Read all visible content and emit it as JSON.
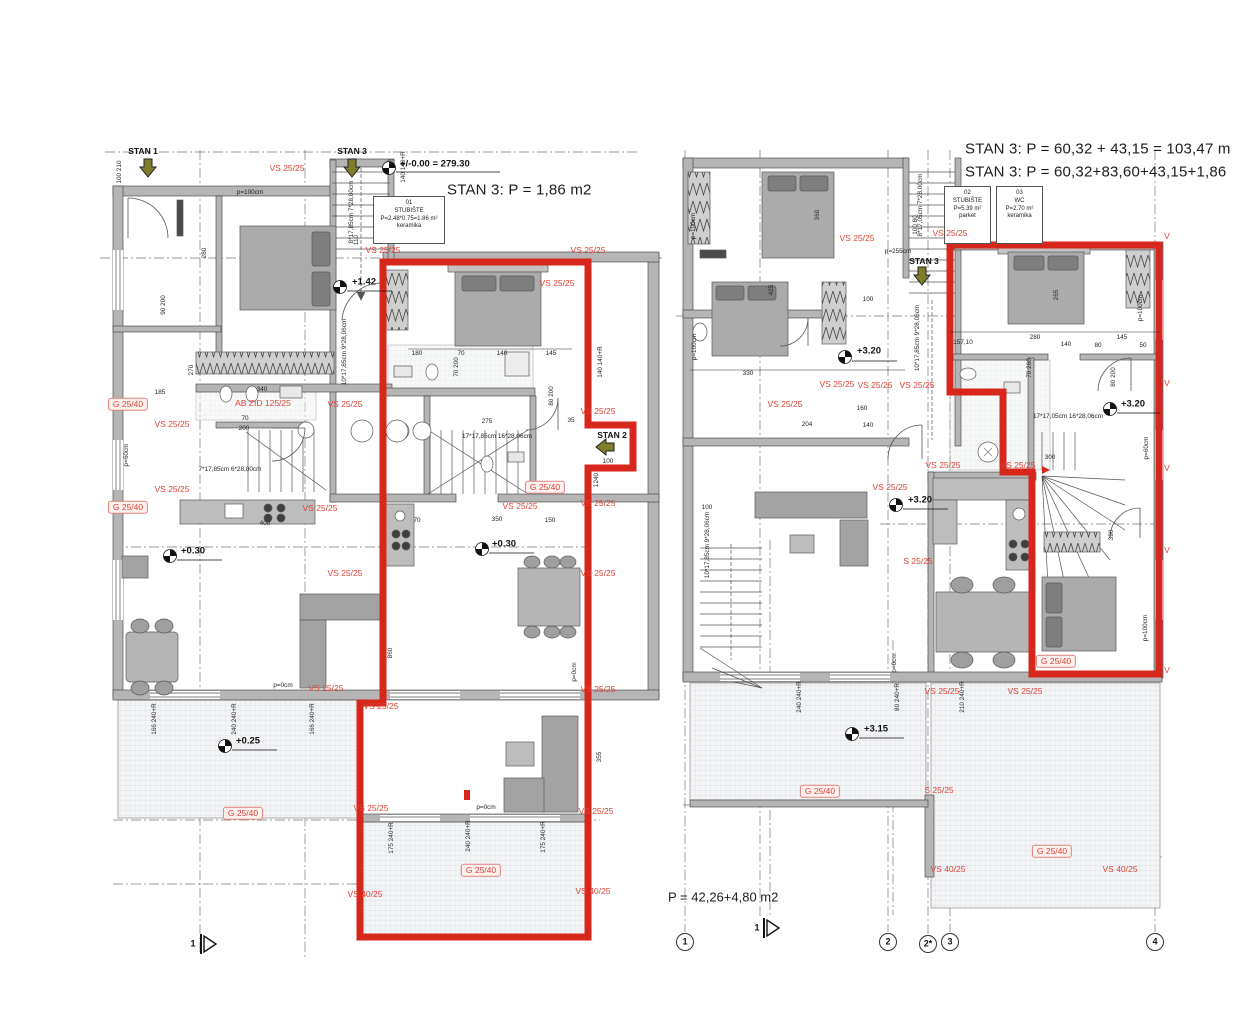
{
  "colors": {
    "outline_red": "#d7261b",
    "label_red": "#e04237",
    "wall_gray": "#b5b5b5"
  },
  "room_boxes": [
    {
      "id": "01",
      "name": "STUBIŠTE",
      "calc": "P=2.48*0.75=1.86 m²",
      "floor": "keramika"
    },
    {
      "id": "02",
      "name": "STUBIŠTE",
      "calc": "P=5.39 m²",
      "floor": "parket"
    },
    {
      "id": "03",
      "name": "WC",
      "calc": "P=2.70 m²",
      "floor": "keramika"
    }
  ],
  "labels": [
    {
      "t": "STAN 3: P = 1,86 m2",
      "x": 447,
      "y": 190,
      "c": "title",
      "a": "l",
      "n": "left-plan-title"
    },
    {
      "t": "STAN 3: P = 60,32 + 43,15 = 103,47 m",
      "x": 965,
      "y": 149,
      "c": "title",
      "a": "l",
      "n": "right-plan-title-1"
    },
    {
      "t": "STAN 3: P = 60,32+83,60+43,15+1,86",
      "x": 965,
      "y": 172,
      "c": "title",
      "a": "l",
      "n": "right-plan-title-2"
    },
    {
      "t": "P = 42,26+4,80 m2",
      "x": 668,
      "y": 897,
      "c": "title2",
      "a": "l",
      "n": "terrace-area-text"
    },
    {
      "t": "STAN 1",
      "x": 143,
      "y": 151,
      "c": "black",
      "n": "entrance-stan1"
    },
    {
      "t": "STAN 3",
      "x": 352,
      "y": 151,
      "c": "black",
      "n": "entrance-stan3-left"
    },
    {
      "t": "STAN 2",
      "x": 612,
      "y": 435,
      "c": "black",
      "n": "entrance-stan2"
    },
    {
      "t": "STAN 3",
      "x": 924,
      "y": 261,
      "c": "black",
      "n": "entrance-stan3-right"
    },
    {
      "t": "+/-0.00 = 279.30",
      "x": 400,
      "y": 164,
      "c": "elev",
      "a": "l"
    },
    {
      "t": "+1.42",
      "x": 352,
      "y": 282,
      "c": "elev",
      "a": "l"
    },
    {
      "t": "+0.30",
      "x": 181,
      "y": 551,
      "c": "elev",
      "a": "l"
    },
    {
      "t": "+0.30",
      "x": 492,
      "y": 544,
      "c": "elev",
      "a": "l"
    },
    {
      "t": "+0.25",
      "x": 236,
      "y": 741,
      "c": "elev",
      "a": "l"
    },
    {
      "t": "+3.20",
      "x": 857,
      "y": 351,
      "c": "elev",
      "a": "l"
    },
    {
      "t": "+3.20",
      "x": 1121,
      "y": 404,
      "c": "elev",
      "a": "l"
    },
    {
      "t": "+3.20",
      "x": 908,
      "y": 500,
      "c": "elev",
      "a": "l"
    },
    {
      "t": "+3.15",
      "x": 864,
      "y": 729,
      "c": "elev",
      "a": "l"
    },
    {
      "t": "VS 25/25",
      "x": 287,
      "y": 168,
      "c": "red"
    },
    {
      "t": "VS 25/25",
      "x": 383,
      "y": 250,
      "c": "red"
    },
    {
      "t": "VS 25/25",
      "x": 588,
      "y": 250,
      "c": "red"
    },
    {
      "t": "VS 25/25",
      "x": 557,
      "y": 283,
      "c": "red"
    },
    {
      "t": "G 25/40",
      "x": 128,
      "y": 404,
      "c": "redbox"
    },
    {
      "t": "AB ZID 125/25",
      "x": 263,
      "y": 403,
      "c": "red"
    },
    {
      "t": "VS 25/25",
      "x": 345,
      "y": 404,
      "c": "red"
    },
    {
      "t": "VS 25/25",
      "x": 172,
      "y": 424,
      "c": "red"
    },
    {
      "t": "VS 25/25",
      "x": 598,
      "y": 411,
      "c": "red"
    },
    {
      "t": "VS 25/25",
      "x": 172,
      "y": 489,
      "c": "red"
    },
    {
      "t": "G 25/40",
      "x": 128,
      "y": 507,
      "c": "redbox"
    },
    {
      "t": "VS 25/25",
      "x": 320,
      "y": 508,
      "c": "red"
    },
    {
      "t": "VS 25/25",
      "x": 520,
      "y": 506,
      "c": "red"
    },
    {
      "t": "G 25/40",
      "x": 545,
      "y": 487,
      "c": "redbox"
    },
    {
      "t": "VS 25/25",
      "x": 598,
      "y": 503,
      "c": "red"
    },
    {
      "t": "VS 25/25",
      "x": 345,
      "y": 573,
      "c": "red"
    },
    {
      "t": "VS 25/25",
      "x": 598,
      "y": 573,
      "c": "red"
    },
    {
      "t": "VS 25/25",
      "x": 326,
      "y": 688,
      "c": "red"
    },
    {
      "t": "VS 25/25",
      "x": 381,
      "y": 706,
      "c": "red"
    },
    {
      "t": "VS 25/25",
      "x": 598,
      "y": 689,
      "c": "red"
    },
    {
      "t": "G 25/40",
      "x": 243,
      "y": 813,
      "c": "redbox"
    },
    {
      "t": "VS 25/25",
      "x": 371,
      "y": 808,
      "c": "red"
    },
    {
      "t": "VS 25/25",
      "x": 596,
      "y": 811,
      "c": "red"
    },
    {
      "t": "G 25/40",
      "x": 481,
      "y": 870,
      "c": "redbox"
    },
    {
      "t": "VS 40/25",
      "x": 365,
      "y": 894,
      "c": "red"
    },
    {
      "t": "VS 40/25",
      "x": 593,
      "y": 891,
      "c": "red"
    },
    {
      "t": "VS 25/25",
      "x": 857,
      "y": 238,
      "c": "red"
    },
    {
      "t": "VS 25/25",
      "x": 950,
      "y": 233,
      "c": "red"
    },
    {
      "t": "VS 25/25",
      "x": 785,
      "y": 404,
      "c": "red"
    },
    {
      "t": "VS 25/25",
      "x": 837,
      "y": 384,
      "c": "red"
    },
    {
      "t": "VS 25/25",
      "x": 875,
      "y": 385,
      "c": "red"
    },
    {
      "t": "VS 25/25",
      "x": 917,
      "y": 385,
      "c": "red"
    },
    {
      "t": "VS 25/25",
      "x": 890,
      "y": 487,
      "c": "red"
    },
    {
      "t": "VS 25/25",
      "x": 943,
      "y": 465,
      "c": "red"
    },
    {
      "t": "VS 25/25",
      "x": 1018,
      "y": 465,
      "c": "red"
    },
    {
      "t": "S 25/25",
      "x": 918,
      "y": 561,
      "c": "red"
    },
    {
      "t": "VS 25/25",
      "x": 942,
      "y": 691,
      "c": "red"
    },
    {
      "t": "VS 25/25",
      "x": 1025,
      "y": 691,
      "c": "red"
    },
    {
      "t": "S 25/25",
      "x": 939,
      "y": 790,
      "c": "red"
    },
    {
      "t": "G 25/40",
      "x": 1056,
      "y": 661,
      "c": "redbox"
    },
    {
      "t": "G 25/40",
      "x": 820,
      "y": 791,
      "c": "redbox"
    },
    {
      "t": "VS 40/25",
      "x": 948,
      "y": 869,
      "c": "red"
    },
    {
      "t": "VS 40/25",
      "x": 1120,
      "y": 869,
      "c": "red"
    },
    {
      "t": "G 25/40",
      "x": 1052,
      "y": 851,
      "c": "redbox"
    },
    {
      "t": "V",
      "x": 1167,
      "y": 236,
      "c": "red"
    },
    {
      "t": "V",
      "x": 1167,
      "y": 383,
      "c": "red"
    },
    {
      "t": "V",
      "x": 1167,
      "y": 468,
      "c": "red"
    },
    {
      "t": "V",
      "x": 1167,
      "y": 550,
      "c": "red"
    },
    {
      "t": "V",
      "x": 1167,
      "y": 670,
      "c": "red"
    },
    {
      "t": "100 210",
      "x": 120,
      "y": 172,
      "c": "dim",
      "r": -90
    },
    {
      "t": "140 140+R",
      "x": 404,
      "y": 167,
      "c": "dim",
      "r": -90
    },
    {
      "t": "p=100cm",
      "x": 250,
      "y": 193,
      "c": "dim"
    },
    {
      "t": "280",
      "x": 205,
      "y": 253,
      "c": "dim",
      "r": -90
    },
    {
      "t": "90 200",
      "x": 164,
      "y": 305,
      "c": "dim",
      "r": -90
    },
    {
      "t": "270",
      "x": 192,
      "y": 370,
      "c": "dim",
      "r": -90
    },
    {
      "t": "185",
      "x": 160,
      "y": 393,
      "c": "dim"
    },
    {
      "t": "340",
      "x": 262,
      "y": 390,
      "c": "dim"
    },
    {
      "t": "70",
      "x": 245,
      "y": 419,
      "c": "dim"
    },
    {
      "t": "200",
      "x": 244,
      "y": 429,
      "c": "dim"
    },
    {
      "t": "p=60cm",
      "x": 127,
      "y": 455,
      "c": "dim",
      "r": -90
    },
    {
      "t": "110",
      "x": 357,
      "y": 240,
      "c": "dim",
      "r": -90
    },
    {
      "t": "8*17,85cm 7*28,00cm",
      "x": 352,
      "y": 212,
      "c": "dim",
      "r": -90
    },
    {
      "t": "10*17,85cm 9*28,06cm",
      "x": 345,
      "y": 352,
      "c": "dim",
      "r": -90
    },
    {
      "t": "7*17,85cm 6*28,00cm",
      "x": 230,
      "y": 470,
      "c": "dim"
    },
    {
      "t": "17*17,85cm 16*28,06cm",
      "x": 497,
      "y": 437,
      "c": "dim"
    },
    {
      "t": "180",
      "x": 417,
      "y": 354,
      "c": "dim"
    },
    {
      "t": "70",
      "x": 461,
      "y": 354,
      "c": "dim"
    },
    {
      "t": "140",
      "x": 502,
      "y": 354,
      "c": "dim"
    },
    {
      "t": "145",
      "x": 551,
      "y": 354,
      "c": "dim"
    },
    {
      "t": "70 200",
      "x": 457,
      "y": 367,
      "c": "dim",
      "r": -90
    },
    {
      "t": "275",
      "x": 487,
      "y": 422,
      "c": "dim"
    },
    {
      "t": "80 200",
      "x": 552,
      "y": 396,
      "c": "dim",
      "r": -90
    },
    {
      "t": "35",
      "x": 571,
      "y": 421,
      "c": "dim"
    },
    {
      "t": "1240",
      "x": 597,
      "y": 480,
      "c": "dim",
      "r": -90
    },
    {
      "t": "140 140+R",
      "x": 601,
      "y": 362,
      "c": "dim",
      "r": -90
    },
    {
      "t": "100",
      "x": 608,
      "y": 462,
      "c": "dim"
    },
    {
      "t": "400",
      "x": 265,
      "y": 524,
      "c": "dim"
    },
    {
      "t": "70",
      "x": 417,
      "y": 521,
      "c": "dim"
    },
    {
      "t": "350",
      "x": 497,
      "y": 520,
      "c": "dim"
    },
    {
      "t": "150",
      "x": 550,
      "y": 521,
      "c": "dim"
    },
    {
      "t": "860",
      "x": 391,
      "y": 653,
      "c": "dim",
      "r": -90
    },
    {
      "t": "355",
      "x": 600,
      "y": 757,
      "c": "dim",
      "r": -90
    },
    {
      "t": "p=0cm",
      "x": 283,
      "y": 686,
      "c": "dim"
    },
    {
      "t": "166 240+R",
      "x": 155,
      "y": 719,
      "c": "dim",
      "r": -90
    },
    {
      "t": "240 240+R",
      "x": 235,
      "y": 719,
      "c": "dim",
      "r": -90
    },
    {
      "t": "166 240+R",
      "x": 313,
      "y": 719,
      "c": "dim",
      "r": -90
    },
    {
      "t": "p=0cm",
      "x": 486,
      "y": 808,
      "c": "dim"
    },
    {
      "t": "p=0cm",
      "x": 575,
      "y": 672,
      "c": "dim",
      "r": -90
    },
    {
      "t": "175 240+R",
      "x": 392,
      "y": 838,
      "c": "dim",
      "r": -90
    },
    {
      "t": "240 240+R",
      "x": 469,
      "y": 836,
      "c": "dim",
      "r": -90
    },
    {
      "t": "175 240+R",
      "x": 544,
      "y": 837,
      "c": "dim",
      "r": -90
    },
    {
      "t": "p=100cm",
      "x": 694,
      "y": 226,
      "c": "dim",
      "r": -90
    },
    {
      "t": "p=100cm",
      "x": 695,
      "y": 347,
      "c": "dim",
      "r": -90
    },
    {
      "t": "360",
      "x": 818,
      "y": 215,
      "c": "dim",
      "r": -90
    },
    {
      "t": "425",
      "x": 772,
      "y": 290,
      "c": "dim",
      "r": -90
    },
    {
      "t": "330",
      "x": 748,
      "y": 374,
      "c": "dim"
    },
    {
      "t": "100",
      "x": 868,
      "y": 300,
      "c": "dim"
    },
    {
      "t": "100 80",
      "x": 916,
      "y": 225,
      "c": "dim",
      "r": -90
    },
    {
      "t": "8*17,05cm 7*28,00cm",
      "x": 921,
      "y": 205,
      "c": "dim",
      "r": -90
    },
    {
      "t": "p=255cm",
      "x": 898,
      "y": 252,
      "c": "dim"
    },
    {
      "t": "10*17,85cm 9*28,06cm",
      "x": 918,
      "y": 338,
      "c": "dim",
      "r": -90
    },
    {
      "t": "10*17,85cm 9*28,06cm",
      "x": 708,
      "y": 545,
      "c": "dim",
      "r": -90
    },
    {
      "t": "100",
      "x": 707,
      "y": 508,
      "c": "dim"
    },
    {
      "t": "157,10",
      "x": 963,
      "y": 343,
      "c": "dim"
    },
    {
      "t": "280",
      "x": 1035,
      "y": 338,
      "c": "dim"
    },
    {
      "t": "140",
      "x": 1066,
      "y": 345,
      "c": "dim"
    },
    {
      "t": "145",
      "x": 1122,
      "y": 338,
      "c": "dim"
    },
    {
      "t": "80",
      "x": 1098,
      "y": 346,
      "c": "dim"
    },
    {
      "t": "50",
      "x": 1143,
      "y": 346,
      "c": "dim"
    },
    {
      "t": "265",
      "x": 1057,
      "y": 295,
      "c": "dim",
      "r": -90
    },
    {
      "t": "70 260",
      "x": 1030,
      "y": 368,
      "c": "dim",
      "r": -90
    },
    {
      "t": "80 200",
      "x": 1114,
      "y": 377,
      "c": "dim",
      "r": -90
    },
    {
      "t": "p=100cm",
      "x": 1141,
      "y": 308,
      "c": "dim",
      "r": -90
    },
    {
      "t": "p=60cm",
      "x": 1147,
      "y": 448,
      "c": "dim",
      "r": -90
    },
    {
      "t": "17*17,05cm 16*28,06cm",
      "x": 1068,
      "y": 417,
      "c": "dim"
    },
    {
      "t": "390",
      "x": 1112,
      "y": 535,
      "c": "dim",
      "r": -90
    },
    {
      "t": "300",
      "x": 1050,
      "y": 458,
      "c": "dim"
    },
    {
      "t": "p=100cm",
      "x": 1146,
      "y": 628,
      "c": "dim",
      "r": -90
    },
    {
      "t": "240 240+R",
      "x": 800,
      "y": 697,
      "c": "dim",
      "r": -90
    },
    {
      "t": "80 240+R",
      "x": 898,
      "y": 697,
      "c": "dim",
      "r": -90
    },
    {
      "t": "210 240+R",
      "x": 963,
      "y": 697,
      "c": "dim",
      "r": -90
    },
    {
      "t": "p=0cm",
      "x": 895,
      "y": 663,
      "c": "dim",
      "r": -90
    },
    {
      "t": "204",
      "x": 807,
      "y": 425,
      "c": "dim"
    },
    {
      "t": "160",
      "x": 862,
      "y": 409,
      "c": "dim"
    },
    {
      "t": "140",
      "x": 868,
      "y": 426,
      "c": "dim"
    },
    {
      "t": "1",
      "x": 685,
      "y": 942,
      "c": "axis",
      "n": "axis-bubble-1"
    },
    {
      "t": "2",
      "x": 888,
      "y": 942,
      "c": "axis",
      "n": "axis-bubble-2"
    },
    {
      "t": "2*",
      "x": 928,
      "y": 944,
      "c": "axis",
      "n": "axis-bubble-2s"
    },
    {
      "t": "3",
      "x": 950,
      "y": 942,
      "c": "axis",
      "n": "axis-bubble-3"
    },
    {
      "t": "4",
      "x": 1155,
      "y": 942,
      "c": "axis",
      "n": "axis-bubble-4"
    },
    {
      "t": "1",
      "x": 193,
      "y": 944,
      "c": "axis",
      "n": "section-marker-1-left"
    },
    {
      "t": "1",
      "x": 757,
      "y": 928,
      "c": "axis",
      "n": "section-marker-1-right"
    }
  ]
}
